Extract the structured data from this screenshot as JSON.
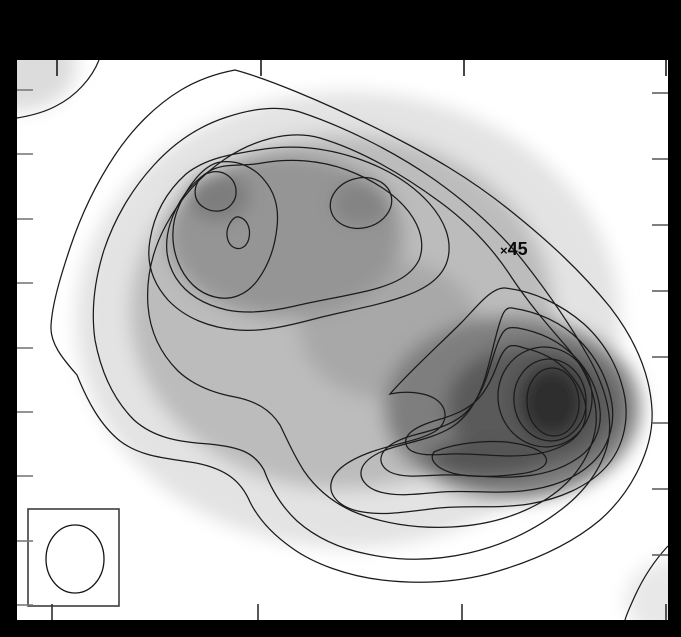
{
  "figure": {
    "background": "#000000",
    "plot": {
      "x": 17,
      "y": 60,
      "width": 651,
      "height": 560,
      "fill": "#ffffff"
    },
    "marker": {
      "symbol": "×",
      "label": "45",
      "x": 509,
      "y": 251
    },
    "beam": {
      "box": {
        "x": 28,
        "y": 509,
        "width": 91,
        "height": 97,
        "stroke": "#3d3d3d"
      },
      "ellipse": {
        "cx": 75,
        "cy": 559,
        "rx": 29,
        "ry": 34,
        "stroke": "#141414"
      }
    },
    "ticks": {
      "length": 16,
      "top": {
        "edge": 60,
        "color": "#1a1a1a",
        "positions": [
          57,
          261,
          464,
          666
        ]
      },
      "bottom": {
        "edge": 620,
        "color": "#2e2e2e",
        "positions": [
          52,
          258,
          462,
          666
        ]
      },
      "left": {
        "edge": 17,
        "color": "#7a7a7a",
        "positions": [
          90,
          154,
          219,
          283,
          348,
          412,
          476,
          541,
          605
        ]
      },
      "right": {
        "edge": 668,
        "color": "#5f5f5f",
        "positions": [
          93,
          159,
          225,
          291,
          357,
          423,
          489,
          555
        ]
      }
    }
  },
  "chart_data": {
    "type": "heatmap",
    "subtype": "filled-contour-map",
    "title": "",
    "xlabel": "",
    "ylabel": "",
    "colormap": "grayscale, white = low intensity, black = high intensity",
    "contour_levels_count": 10,
    "grid": false,
    "legend": false,
    "axis_tick_counts": {
      "top": 4,
      "bottom": 4,
      "left": 9,
      "right": 8
    },
    "axis_tick_labels_visible": false,
    "features": [
      {
        "name": "northwest-lobe",
        "x_px": 260,
        "y_px": 235,
        "relative_intensity": 0.55,
        "note": "extended lobe enclosing two sub-peaks and one local dip"
      },
      {
        "name": "northwest-subpeak-kidney",
        "x_px": 216,
        "y_px": 191,
        "relative_intensity": 0.62
      },
      {
        "name": "northeast-subpeak-oval",
        "x_px": 361,
        "y_px": 203,
        "relative_intensity": 0.6
      },
      {
        "name": "local-dip-between-subpeaks",
        "x_px": 240,
        "y_px": 233,
        "relative_intensity": 0.5
      },
      {
        "name": "southeast-peak",
        "x_px": 553,
        "y_px": 402,
        "relative_intensity": 1.0,
        "note": "strongest, darkest closed contour of map"
      },
      {
        "name": "southwest-ridge-extension",
        "x_px": 489,
        "y_px": 458,
        "relative_intensity": 0.75,
        "note": "elongated closed contour trailing SW from SE peak"
      },
      {
        "name": "top-left-corner-emission",
        "x_px": 20,
        "y_px": 68,
        "relative_intensity": 0.15
      },
      {
        "name": "bottom-right-corner-emission",
        "x_px": 670,
        "y_px": 598,
        "relative_intensity": 0.1
      }
    ],
    "annotations": [
      {
        "text": "45",
        "marker_symbol": "×",
        "x_px": 509,
        "y_px": 251
      }
    ],
    "beam_inset": {
      "shape": "ellipse",
      "cx_px": 75,
      "cy_px": 559,
      "rx_px": 29,
      "ry_px": 34,
      "box_px": [
        28,
        509,
        119,
        606
      ]
    }
  },
  "shading": {
    "blur": 9,
    "blobs": [
      {
        "name": "emission-base-shade",
        "cx": 348,
        "cy": 320,
        "rx": 272,
        "ry": 228,
        "fill": "#e3e3e3"
      },
      {
        "name": "emission-mid-shade",
        "cx": 342,
        "cy": 312,
        "rx": 212,
        "ry": 178,
        "fill": "#bcbcbc"
      },
      {
        "name": "saddle-shade",
        "cx": 390,
        "cy": 330,
        "rx": 90,
        "ry": 70,
        "fill": "#a8a8a8"
      },
      {
        "name": "north-lobe-shade",
        "cx": 285,
        "cy": 235,
        "rx": 118,
        "ry": 82,
        "fill": "#959595"
      },
      {
        "name": "kidney-subpeak-shade",
        "cx": 218,
        "cy": 196,
        "rx": 32,
        "ry": 25,
        "fill": "#7d7d7d"
      },
      {
        "name": "ne-subpeak-shade",
        "cx": 361,
        "cy": 203,
        "rx": 30,
        "ry": 22,
        "fill": "#838383"
      },
      {
        "name": "se-outer-shade",
        "cx": 512,
        "cy": 408,
        "rx": 128,
        "ry": 92,
        "fill": "#7e7e7e"
      },
      {
        "name": "se-mid-shade",
        "cx": 533,
        "cy": 406,
        "rx": 86,
        "ry": 62,
        "fill": "#5a5a5a"
      },
      {
        "name": "sw-ridge-shade",
        "cx": 489,
        "cy": 458,
        "rx": 62,
        "ry": 19,
        "fill": "#555555"
      },
      {
        "name": "se-core-shade",
        "cx": 552,
        "cy": 402,
        "rx": 34,
        "ry": 38,
        "fill": "#2e2e2e"
      },
      {
        "name": "top-left-corner-shade",
        "cx": 20,
        "cy": 66,
        "rx": 56,
        "ry": 44,
        "fill": "#dcdcdc"
      },
      {
        "name": "bottom-right-corner-shade",
        "cx": 672,
        "cy": 600,
        "rx": 46,
        "ry": 40,
        "fill": "#e8e8e8"
      }
    ]
  },
  "contours": {
    "stroke": "#1b1b1b",
    "stroke_width": 1.25,
    "paths": [
      {
        "name": "outer-contour-1",
        "d": "M 235 70 C 265 78 320 100 380 130 C 430 155 470 178 512 212 C 548 241 580 270 610 307 C 634 338 650 372 652 410 C 654 448 632 492 600 520 C 568 547 528 563 488 574 C 452 583 416 584 382 580 C 348 576 314 564 292 548 C 272 534 258 518 250 502 C 241 481 226 469 196 463 C 166 458 141 457 120 441 C 100 425 87 400 77 375 C 62 358 50 343 51 326 C 52 305 60 278 70 248 C 80 218 95 185 115 155 C 133 128 156 105 181 90 C 201 78 219 73 235 70 Z"
      },
      {
        "name": "contour-2",
        "d": "M 300 112 C 342 126 392 150 435 180 C 470 205 500 232 524 262 C 549 294 571 326 589 358 C 604 385 612 412 609 437 C 605 463 588 489 562 509 C 536 529 504 545 469 553 C 434 561 399 561 367 554 C 337 548 314 536 297 521 C 281 506 271 489 264 470 C 254 452 239 447 209 444 C 179 442 154 438 134 420 C 114 400 101 372 95 340 C 91 312 94 282 104 250 C 114 220 131 190 154 165 C 174 143 199 126 227 117 C 251 109 277 105 300 112 Z"
      },
      {
        "name": "contour-3",
        "d": "M 320 138 C 360 150 402 174 440 202 C 470 224 494 250 512 278 C 528 302 545 322 565 345 C 585 368 598 395 596 425 C 592 455 575 480 548 498 C 520 516 488 525 452 527 C 415 529 380 523 352 511 C 330 501 315 487 304 471 C 293 454 287 439 280 425 C 270 409 255 401 235 397 C 213 393 193 385 178 371 C 160 353 150 331 148 306 C 146 279 152 251 166 225 C 180 199 200 176 225 159 C 252 141 288 129 320 138 Z"
      },
      {
        "name": "north-lobe-contour-4",
        "d": "M 258 150 C 292 144 326 148 356 158 C 386 168 411 183 429 203 C 445 221 452 240 448 258 C 444 276 428 288 405 296 C 380 305 350 310 318 318 C 288 326 262 332 238 330 C 210 328 185 318 168 300 C 152 282 146 262 150 240 C 154 215 166 192 186 174 C 206 158 232 154 258 150 Z"
      },
      {
        "name": "north-lobe-contour-5",
        "d": "M 262 163 C 290 158 320 160 347 170 C 373 180 395 194 409 212 C 421 228 425 245 419 260 C 411 276 394 284 371 290 C 347 296 321 300 295 306 C 269 312 247 314 227 310 C 205 305 187 295 176 278 C 166 262 164 244 170 224 C 177 202 190 184 208 172 C 224 162 240 167 262 163 Z"
      },
      {
        "name": "northwest-peak-contour-6",
        "d": "M 221 162 C 239 160 255 168 265 181 C 275 193 279 209 277 227 C 275 247 269 265 257 281 C 246 295 231 301 215 297 C 198 293 185 280 178 262 C 171 244 171 224 179 206 C 187 188 203 164 221 162 Z"
      },
      {
        "name": "northwest-peak-kidney-contour",
        "d": "M 212 172 C 224 170 235 178 236 190 C 237 201 229 210 219 211 C 210 212 199 207 196 198 C 193 188 198 179 205 174 Z"
      },
      {
        "name": "local-dip-contour",
        "d": "M 239 217 C 247 219 251 228 249 238 C 247 247 240 251 233 247 C 227 243 225 233 229 225 C 232 219 235 216 239 217 Z"
      },
      {
        "name": "se-contour-4",
        "d": "M 505 288 C 533 291 561 304 584 324 C 606 344 620 370 625 398 C 629 424 622 450 605 468 C 587 487 559 499 529 504 C 497 509 467 505 439 508 C 411 511 387 516 363 512 C 343 509 329 498 331 484 C 333 470 349 460 371 452 C 393 444 418 441 434 432 C 446 425 448 413 441 404 C 432 393 410 390 390 394 C 410 371 440 344 461 323 C 475 309 491 287 505 288 Z"
      },
      {
        "name": "se-contour-5",
        "d": "M 512 308 C 538 312 561 322 579 340 C 597 358 608 380 612 404 C 615 426 608 448 592 463 C 575 479 550 488 522 491 C 495 494 468 490 442 492 C 418 494 398 497 380 492 C 366 488 358 478 362 468 C 366 458 380 451 398 446 C 416 441 436 437 452 427 C 466 418 476 403 483 384 C 490 364 494 340 500 322 C 503 312 506 307 512 308 Z"
      },
      {
        "name": "se-contour-6",
        "d": "M 518 328 C 540 332 559 341 574 356 C 589 371 598 390 600 410 C 602 429 594 447 578 458 C 561 470 538 476 513 477 C 488 478 464 474 441 475 C 420 476 402 478 390 472 C 381 467 378 459 384 451 C 390 443 402 438 418 434 C 434 430 450 425 462 416 C 472 408 480 395 486 379 C 492 362 496 344 502 334 C 506 327 511 327 518 328 Z"
      },
      {
        "name": "se-contour-7",
        "d": "M 524 348 C 542 352 557 360 568 372 C 579 384 586 398 586 412 C 586 426 578 438 564 445 C 549 453 530 456 510 456 C 490 456 470 453 450 454 C 433 455 419 456 410 450 C 404 445 404 438 411 432 C 418 426 430 422 444 418 C 456 414 468 409 477 400 C 485 392 491 381 496 368 C 500 357 504 348 510 346 C 514 345 519 346 524 348 Z"
      },
      {
        "name": "sw-ridge-contour",
        "d": "M 434 452 C 452 444 482 440 506 442 C 526 444 543 450 546 458 C 549 466 537 472 519 474 C 496 477 466 478 449 472 C 435 467 429 459 434 452 Z"
      },
      {
        "name": "top-left-corner-contour",
        "d": "M 99 60 C 92 78 76 96 56 106 C 43 113 29 116 17 118"
      },
      {
        "name": "bottom-right-corner-contour",
        "d": "M 668 546 C 654 561 642 580 634 598 C 630 607 627 613 625 620"
      }
    ],
    "ellipses": [
      {
        "name": "northeast-subpeak-contour",
        "cx": 361,
        "cy": 203,
        "rx": 31,
        "ry": 25,
        "rot": -14
      },
      {
        "name": "se-contour-8",
        "cx": 545,
        "cy": 397,
        "rx": 47,
        "ry": 50,
        "rot": -8
      },
      {
        "name": "se-contour-9",
        "cx": 550,
        "cy": 400,
        "rx": 36,
        "ry": 41,
        "rot": -6
      },
      {
        "name": "se-peak-core-contour",
        "cx": 553,
        "cy": 402,
        "rx": 26,
        "ry": 34,
        "rot": -4
      }
    ]
  }
}
